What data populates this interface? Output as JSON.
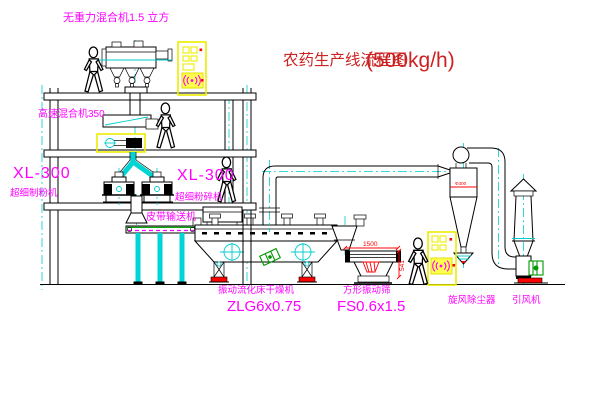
{
  "title": {
    "text": "农药生产线流程图",
    "capacity": "(500kg/h)"
  },
  "labels": {
    "gravity_mixer": "无重力混合机1.5 立方",
    "high_speed_mixer": "高速混合机350",
    "mill_left_model": "XL-300",
    "mill_left_name": "超细制粉机",
    "mill_right_model": "XL-300",
    "mill_right_name": "超细粉碎机",
    "belt_conveyor": "皮带输送机",
    "dryer_name": "振动流化床干燥机",
    "dryer_model": "ZLG6x0.75",
    "screen_name": "方形振动筛",
    "screen_model": "FS0.6x1.5",
    "cyclone": "旋风除尘器",
    "fan": "引风机",
    "cyclone_tag": "Φ300"
  },
  "dimensions": {
    "screen_length": "1500",
    "screen_height": "541"
  },
  "colors": {
    "label_magenta": "#ff00ff",
    "title_red": "#cc2222",
    "dimension_red": "#ff0000",
    "centerline_cyan": "#00cccc",
    "cabinet_yellow": "#f0f000",
    "machine_green": "#009900",
    "belt_green": "#00a800",
    "pad_red": "#ff0000"
  }
}
